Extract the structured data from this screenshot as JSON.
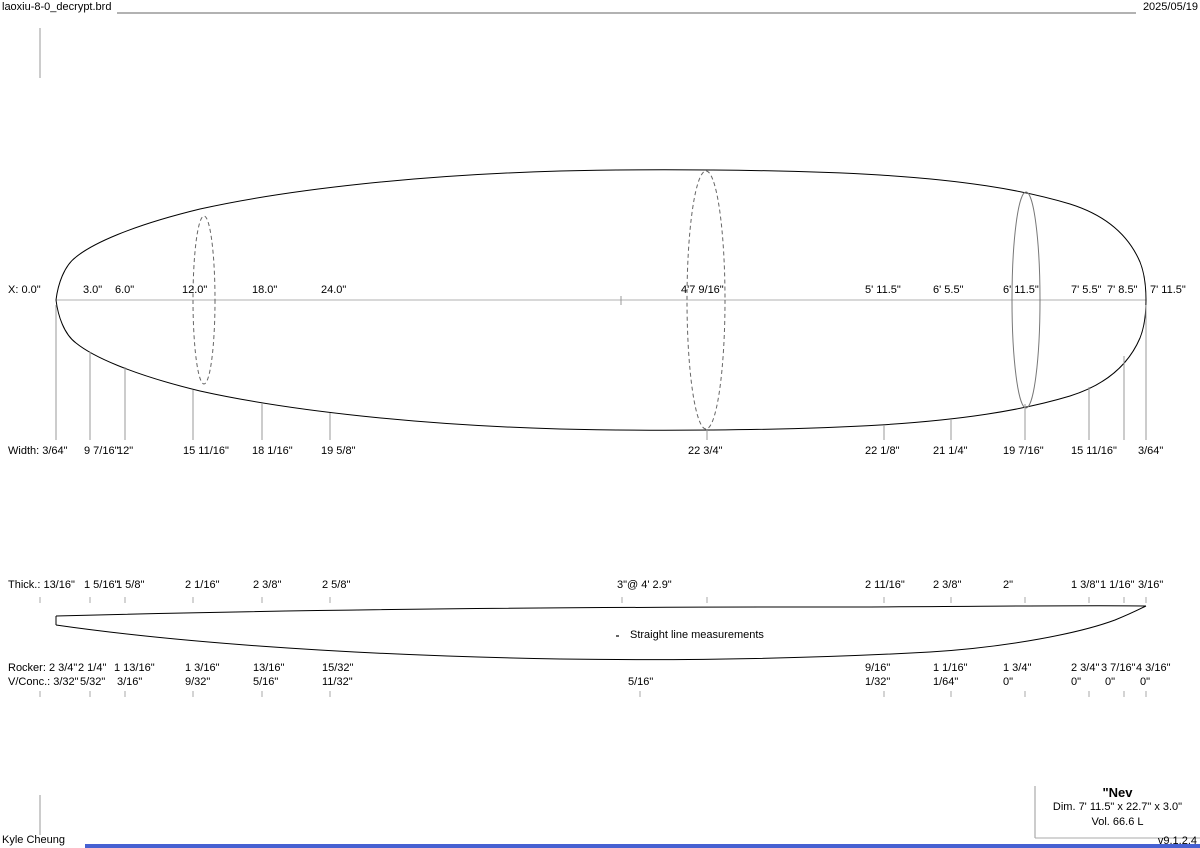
{
  "header": {
    "filename": "laoxiu-8-0_decrypt.brd",
    "date": "2025/05/19"
  },
  "board": {
    "name": "\"Nev",
    "dimensions": "Dim. 7' 11.5\" x 22.7\" x 3.0\"",
    "volume": "Vol. 66.6 L"
  },
  "annotations": {
    "straight_line": "Straight line measurements"
  },
  "footer": {
    "author": "Kyle Cheung",
    "version": "v9.1.2.4",
    "accent_color": "#4661d2"
  },
  "measurement_rows": [
    {
      "id": "x-positions",
      "top": 284,
      "items": [
        {
          "x": 8,
          "t": "X: 0.0\""
        },
        {
          "x": 83,
          "t": "3.0\""
        },
        {
          "x": 115,
          "t": "6.0\""
        },
        {
          "x": 182,
          "t": "12.0\""
        },
        {
          "x": 252,
          "t": "18.0\""
        },
        {
          "x": 321,
          "t": "24.0\""
        },
        {
          "x": 681,
          "t": "4'7 9/16\""
        },
        {
          "x": 865,
          "t": "5' 11.5\""
        },
        {
          "x": 933,
          "t": "6' 5.5\""
        },
        {
          "x": 1003,
          "t": "6' 11.5\""
        },
        {
          "x": 1071,
          "t": "7' 5.5\""
        },
        {
          "x": 1107,
          "t": "7' 8.5\""
        },
        {
          "x": 1150,
          "t": "7' 11.5\""
        }
      ]
    },
    {
      "id": "widths",
      "top": 445,
      "items": [
        {
          "x": 8,
          "t": "Width: 3/64\""
        },
        {
          "x": 84,
          "t": "9 7/16\""
        },
        {
          "x": 117,
          "t": "12\""
        },
        {
          "x": 183,
          "t": "15 11/16\""
        },
        {
          "x": 252,
          "t": "18 1/16\""
        },
        {
          "x": 321,
          "t": "19 5/8\""
        },
        {
          "x": 688,
          "t": "22 3/4\""
        },
        {
          "x": 865,
          "t": "22 1/8\""
        },
        {
          "x": 933,
          "t": "21 1/4\""
        },
        {
          "x": 1003,
          "t": "19 7/16\""
        },
        {
          "x": 1071,
          "t": "15 11/16\""
        },
        {
          "x": 1138,
          "t": "3/64\""
        }
      ]
    },
    {
      "id": "thickness",
      "top": 579,
      "items": [
        {
          "x": 8,
          "t": "Thick.: 13/16\""
        },
        {
          "x": 84,
          "t": "1 5/16\""
        },
        {
          "x": 116,
          "t": "1 5/8\""
        },
        {
          "x": 185,
          "t": "2 1/16\""
        },
        {
          "x": 253,
          "t": "2 3/8\""
        },
        {
          "x": 322,
          "t": "2 5/8\""
        },
        {
          "x": 617,
          "t": "3\"@ 4' 2.9\""
        },
        {
          "x": 865,
          "t": "2 11/16\""
        },
        {
          "x": 933,
          "t": "2 3/8\""
        },
        {
          "x": 1003,
          "t": "2\""
        },
        {
          "x": 1071,
          "t": "1 3/8\""
        },
        {
          "x": 1100,
          "t": "1 1/16\""
        },
        {
          "x": 1138,
          "t": "3/16\""
        }
      ]
    },
    {
      "id": "rocker",
      "top": 662,
      "items": [
        {
          "x": 8,
          "t": "Rocker: 2 3/4\""
        },
        {
          "x": 78,
          "t": "2 1/4\""
        },
        {
          "x": 114,
          "t": "1 13/16\""
        },
        {
          "x": 185,
          "t": "1 3/16\""
        },
        {
          "x": 253,
          "t": "13/16\""
        },
        {
          "x": 322,
          "t": "15/32\""
        },
        {
          "x": 865,
          "t": "9/16\""
        },
        {
          "x": 933,
          "t": "1 1/16\""
        },
        {
          "x": 1003,
          "t": "1 3/4\""
        },
        {
          "x": 1071,
          "t": "2 3/4\""
        },
        {
          "x": 1101,
          "t": "3 7/16\""
        },
        {
          "x": 1136,
          "t": "4 3/16\""
        }
      ]
    },
    {
      "id": "vconcave",
      "top": 676,
      "items": [
        {
          "x": 8,
          "t": "V/Conc.: 3/32\""
        },
        {
          "x": 80,
          "t": "5/32\""
        },
        {
          "x": 117,
          "t": "3/16\""
        },
        {
          "x": 185,
          "t": "9/32\""
        },
        {
          "x": 253,
          "t": "5/16\""
        },
        {
          "x": 322,
          "t": "11/32\""
        },
        {
          "x": 628,
          "t": "5/16\""
        },
        {
          "x": 865,
          "t": "1/32\""
        },
        {
          "x": 933,
          "t": "1/64\""
        },
        {
          "x": 1003,
          "t": "0\""
        },
        {
          "x": 1071,
          "t": "0\""
        },
        {
          "x": 1105,
          "t": "0\""
        },
        {
          "x": 1140,
          "t": "0\""
        }
      ]
    }
  ]
}
